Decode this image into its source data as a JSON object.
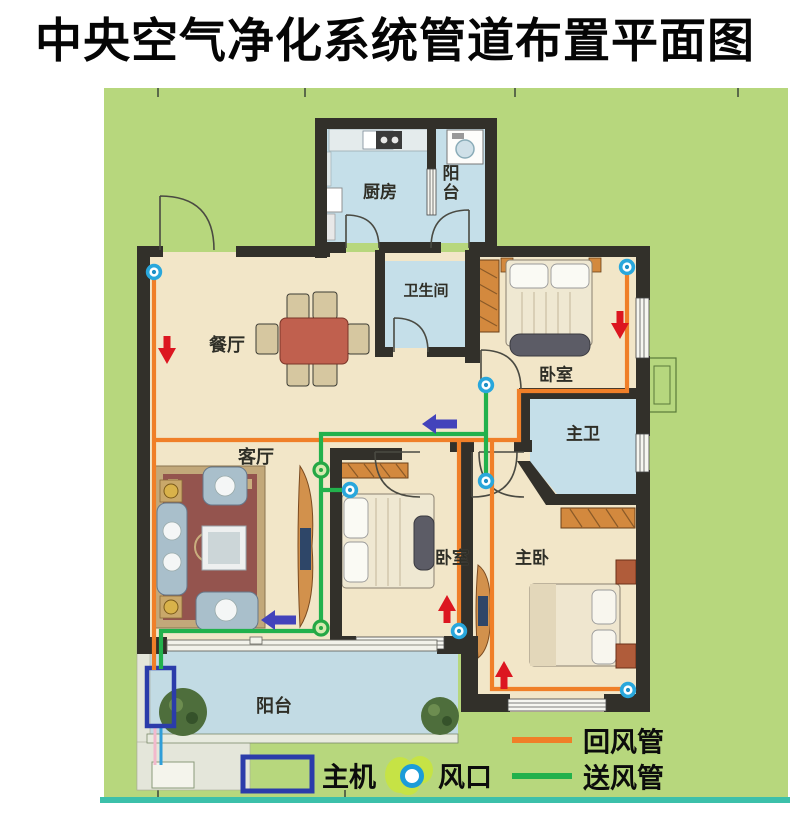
{
  "title": "中央空气净化系统管道布置平面图",
  "rooms": [
    {
      "id": "kitchen",
      "label": "厨房"
    },
    {
      "id": "balcony-top",
      "label": "阳台"
    },
    {
      "id": "bathroom",
      "label": "卫生间"
    },
    {
      "id": "dining",
      "label": "餐厅"
    },
    {
      "id": "living",
      "label": "客厅"
    },
    {
      "id": "bedroom-1",
      "label": "卧室"
    },
    {
      "id": "master-bath",
      "label": "主卫"
    },
    {
      "id": "bedroom-2",
      "label": "卧室"
    },
    {
      "id": "master-bedroom",
      "label": "主卧"
    },
    {
      "id": "balcony-bottom",
      "label": "阳台"
    }
  ],
  "legend": {
    "main_unit": "主机",
    "vent": "风口",
    "return_duct": "回风管",
    "supply_duct": "送风管"
  },
  "colors": {
    "board_green": "#b7d77d",
    "room_cream": "#f2e6c8",
    "room_blue": "#c5dfe9",
    "wall": "#32302a",
    "return_duct": "#f07f28",
    "supply_duct": "#22b14c",
    "vent_ring": "#29a7dc",
    "vent_green": "#25a845",
    "arrow_red": "#dc1620",
    "arrow_blue": "#4343bb",
    "main_unit_blue": "#2b3caa",
    "teal_line": "#3cc0aa"
  },
  "plan": {
    "pipes": [
      {
        "name": "return-left-riser",
        "duct": "return",
        "points": "154,272 154,670"
      },
      {
        "name": "return-main-run",
        "duct": "return",
        "points": "154,440 519,440 519,391 627,391 627,267"
      },
      {
        "name": "return-bedroom2-drop",
        "duct": "return",
        "points": "459,440 459,631"
      },
      {
        "name": "return-master-loop",
        "duct": "return",
        "points": "492,440 492,689 628,689"
      },
      {
        "name": "supply-trunk",
        "duct": "supply",
        "points": "161,669 161,631 321,631 321,434 486,434"
      },
      {
        "name": "supply-hall-riser",
        "duct": "supply",
        "points": "486,385 486,481"
      },
      {
        "name": "supply-bedroom2-stub",
        "duct": "supply",
        "points": "321,490 350,490"
      }
    ],
    "vents": [
      {
        "type": "cyan",
        "x": 154,
        "y": 272
      },
      {
        "type": "cyan",
        "x": 627,
        "y": 267
      },
      {
        "type": "cyan",
        "x": 486,
        "y": 385
      },
      {
        "type": "cyan",
        "x": 350,
        "y": 490
      },
      {
        "type": "cyan",
        "x": 459,
        "y": 631
      },
      {
        "type": "cyan",
        "x": 628,
        "y": 690
      },
      {
        "type": "cyan",
        "x": 486,
        "y": 481
      },
      {
        "type": "green",
        "x": 321,
        "y": 470
      },
      {
        "type": "green",
        "x": 321,
        "y": 628
      }
    ],
    "arrows": [
      {
        "dir": "down",
        "color": "red",
        "x": 167,
        "y": 352
      },
      {
        "dir": "down",
        "color": "red",
        "x": 620,
        "y": 327
      },
      {
        "dir": "up",
        "color": "red",
        "x": 447,
        "y": 607
      },
      {
        "dir": "up",
        "color": "red",
        "x": 504,
        "y": 673
      },
      {
        "dir": "left",
        "color": "blue",
        "x": 440,
        "y": 424
      },
      {
        "dir": "left",
        "color": "blue",
        "x": 279,
        "y": 620
      }
    ]
  }
}
